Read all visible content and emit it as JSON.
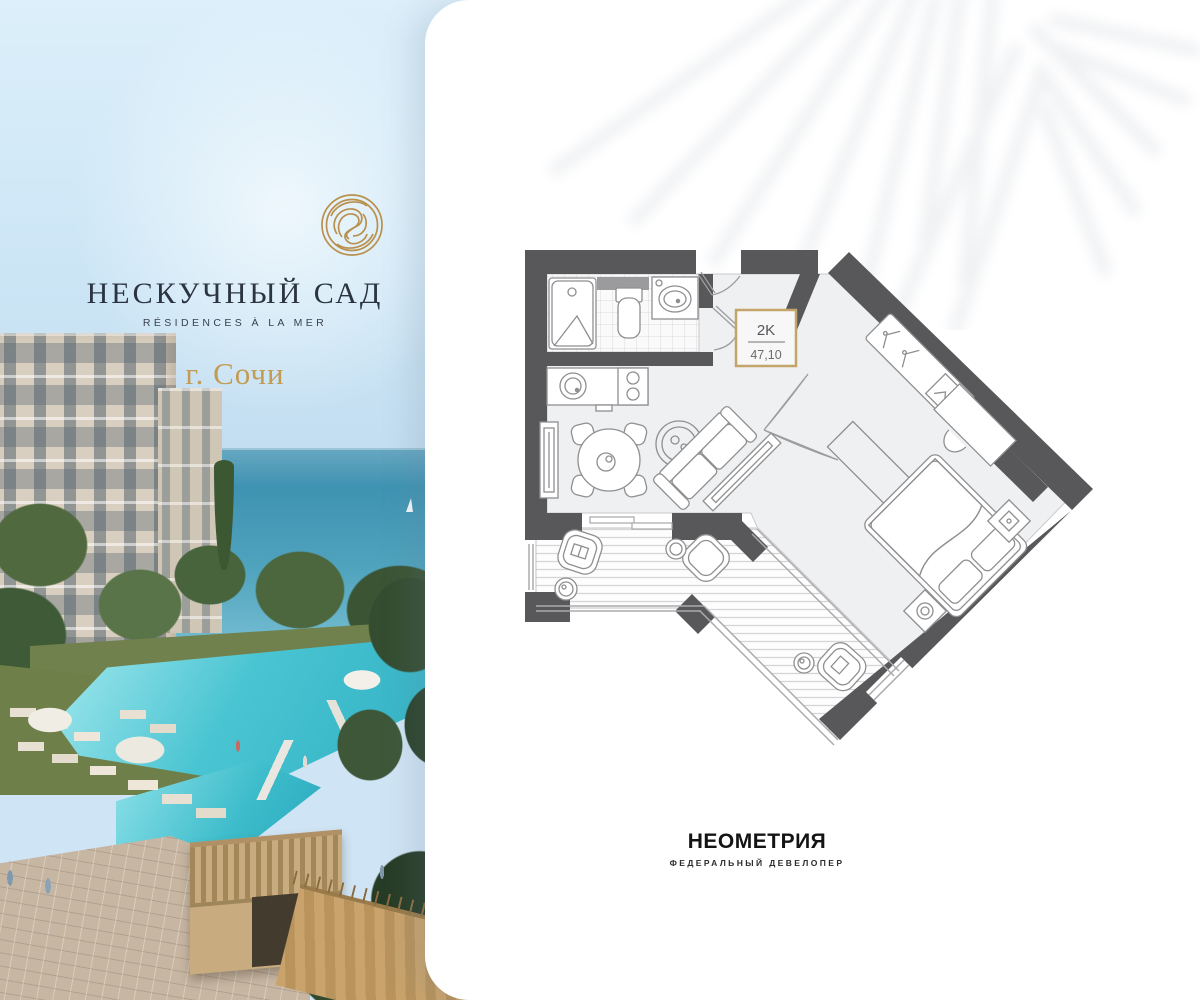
{
  "brand": {
    "name": "НЕСКУЧНЫЙ САД",
    "tagline": "RÉSIDENCES À LA MER",
    "city": "г. Сочи",
    "logo_mark_icon": "gold-spiral-circle-icon"
  },
  "floor_plan": {
    "unit_type": "2K",
    "area_m2": "47,10",
    "depicts": [
      "bathroom",
      "kitchen-living-room",
      "hallway",
      "bedroom",
      "terrace"
    ]
  },
  "developer": {
    "name": "НЕОМЕТРИЯ",
    "descriptor": "ФЕДЕРАЛЬНЫЙ ДЕВЕЛОПЕР"
  },
  "colors": {
    "accent_gold": "#C3A469",
    "wall_gray": "#58585A",
    "floor_gray": "#EEF0F2",
    "brand_text": "#2B3440",
    "city_gold": "#C49B52",
    "pool_turquoise": "#3FBCCB",
    "sea_teal": "#4D9DBB"
  }
}
